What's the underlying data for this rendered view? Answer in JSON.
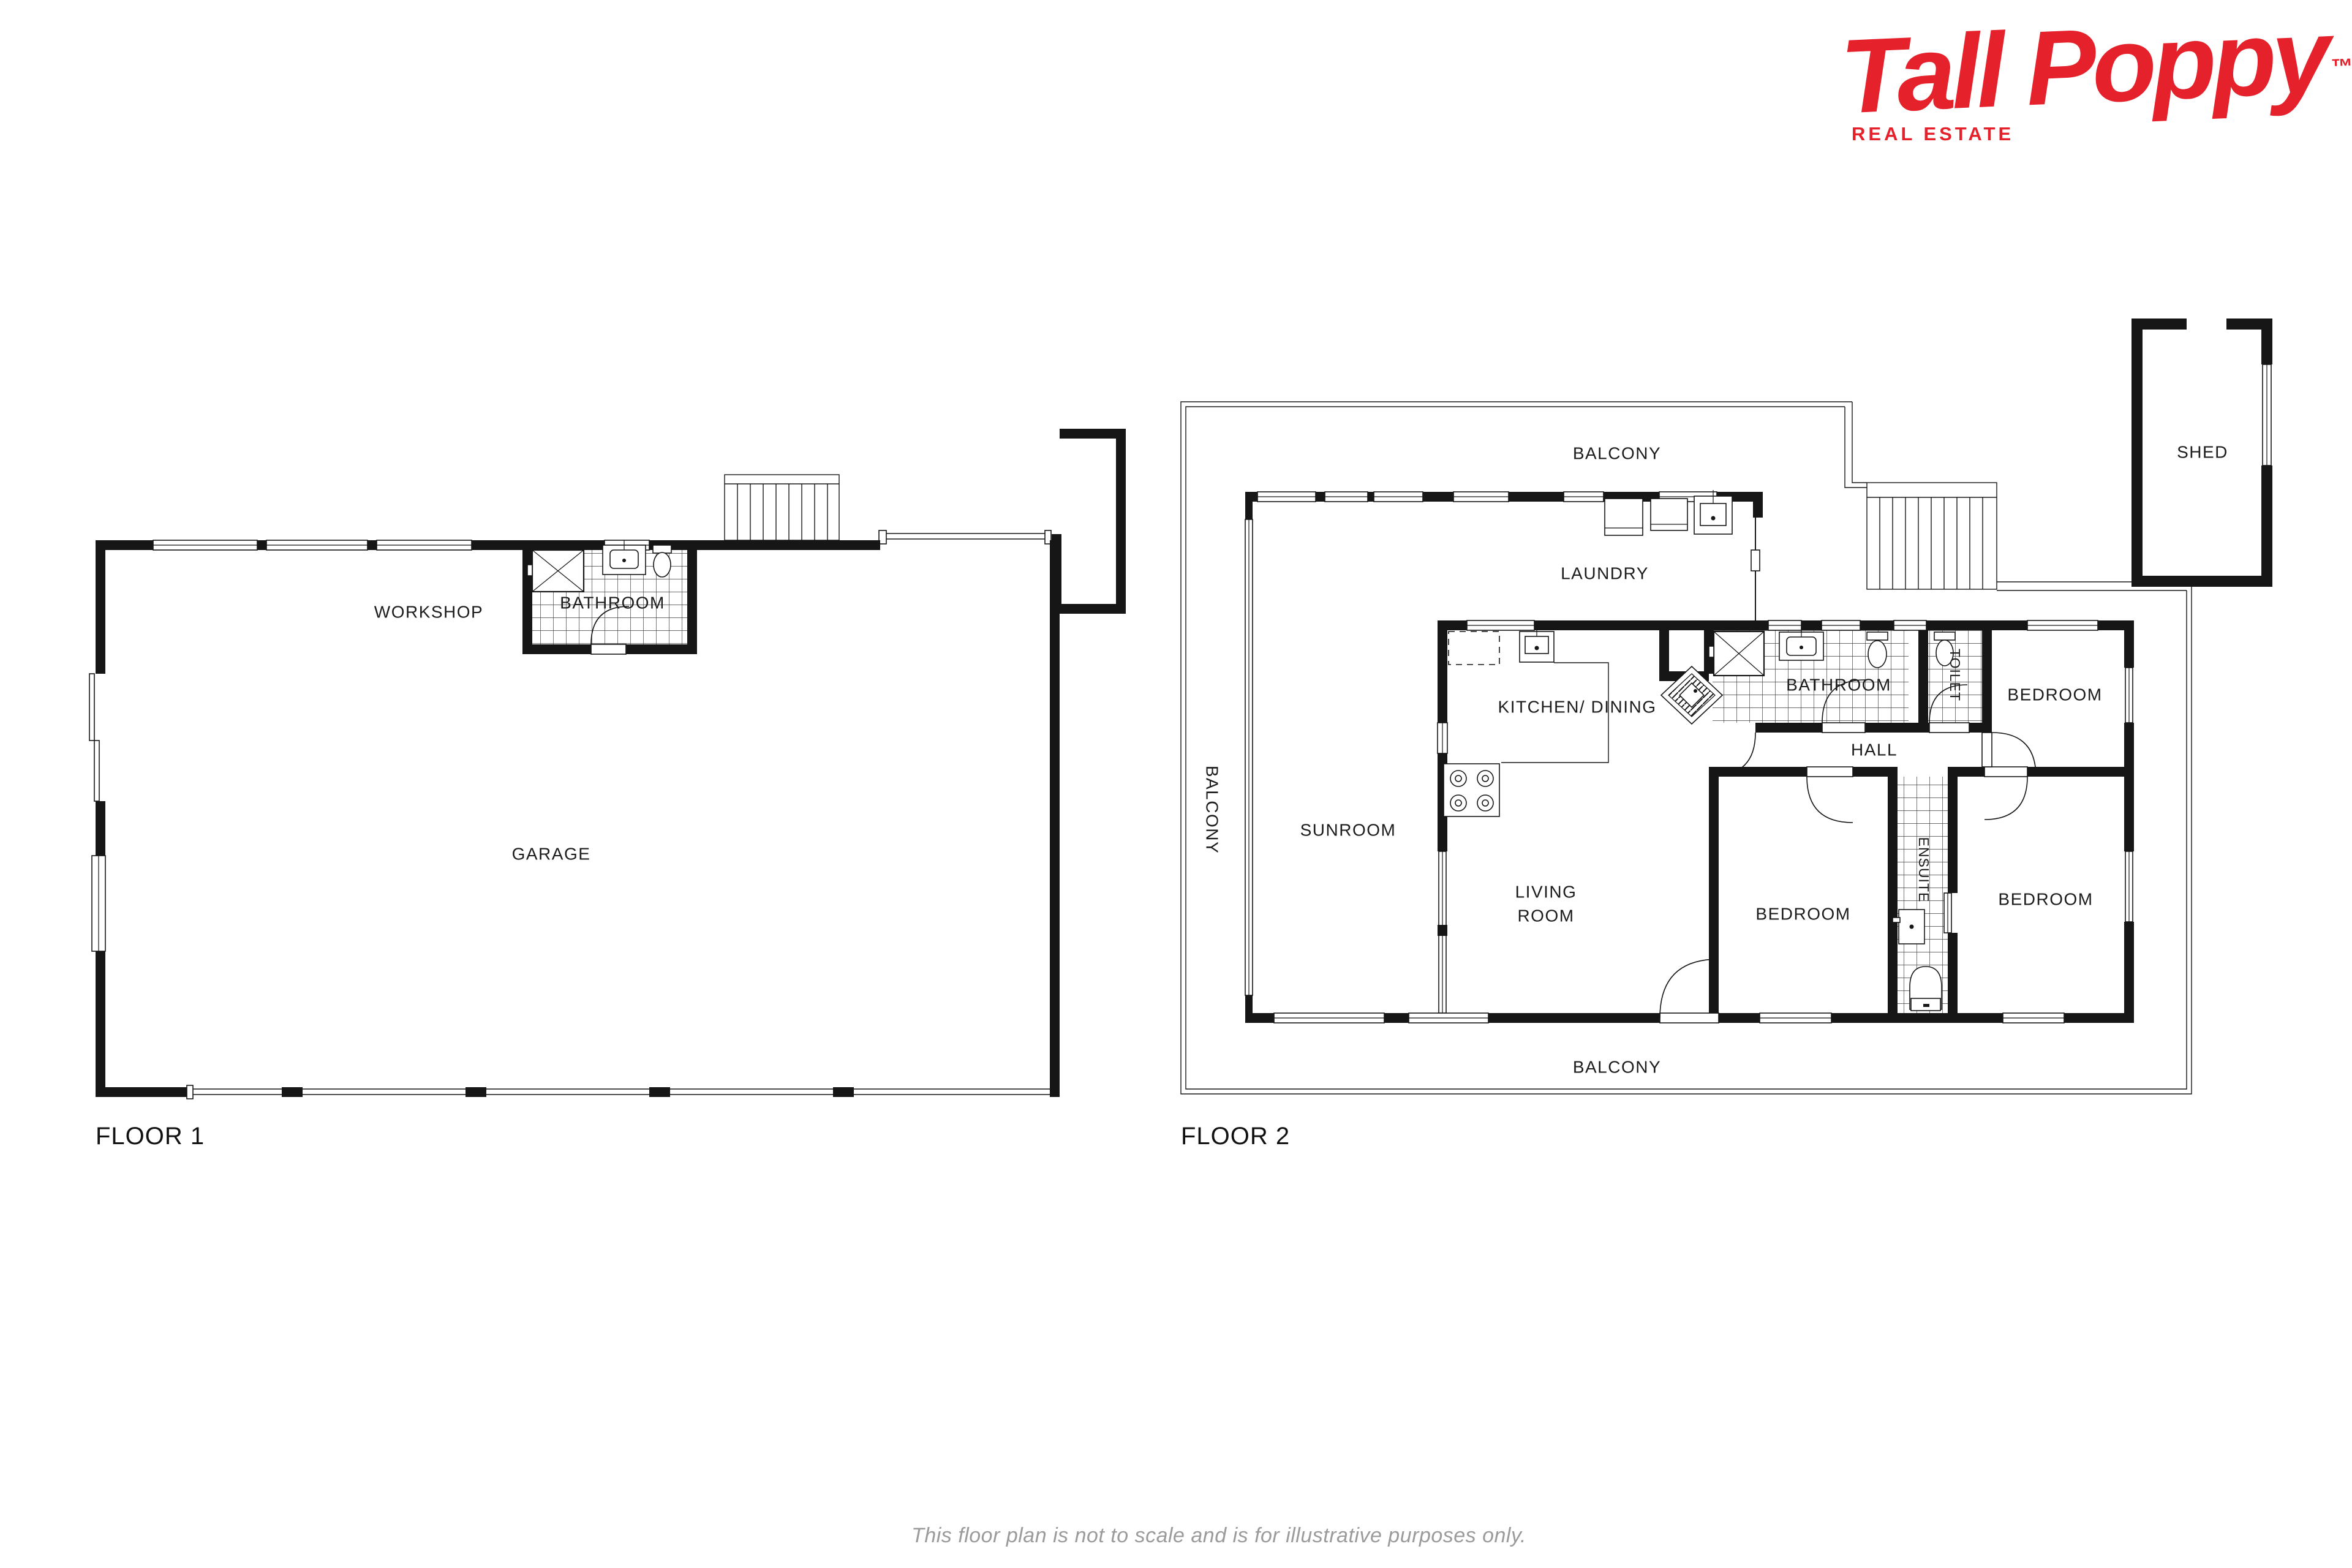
{
  "logo": {
    "brand": "Tall Poppy",
    "trademark": "™",
    "subtitle": "REAL ESTATE",
    "color": "#e5212b"
  },
  "floor1": {
    "title": "FLOOR 1",
    "rooms": {
      "workshop": "WORKSHOP",
      "bathroom": "BATHROOM",
      "garage": "GARAGE"
    }
  },
  "floor2": {
    "title": "FLOOR 2",
    "rooms": {
      "balcony_top": "BALCONY",
      "balcony_left": "BALCONY",
      "balcony_bottom": "BALCONY",
      "shed": "SHED",
      "laundry": "LAUNDRY",
      "kitchen_dining": "KITCHEN/ DINING",
      "bathroom": "BATHROOM",
      "toilet": "TOILET",
      "hall": "HALL",
      "sunroom": "SUNROOM",
      "living_line1": "LIVING",
      "living_line2": "ROOM",
      "bedroom_top": "BEDROOM",
      "bedroom_bottom_center": "BEDROOM",
      "bedroom_bottom_right": "BEDROOM",
      "ensuite": "ENSUITE"
    }
  },
  "footer": {
    "disclaimer": "This floor plan is not to scale and is for illustrative purposes only."
  },
  "colors": {
    "walls": "#161616",
    "logo_red": "#e5212b",
    "disclaimer_gray": "#9b9b9b",
    "background": "#ffffff"
  }
}
